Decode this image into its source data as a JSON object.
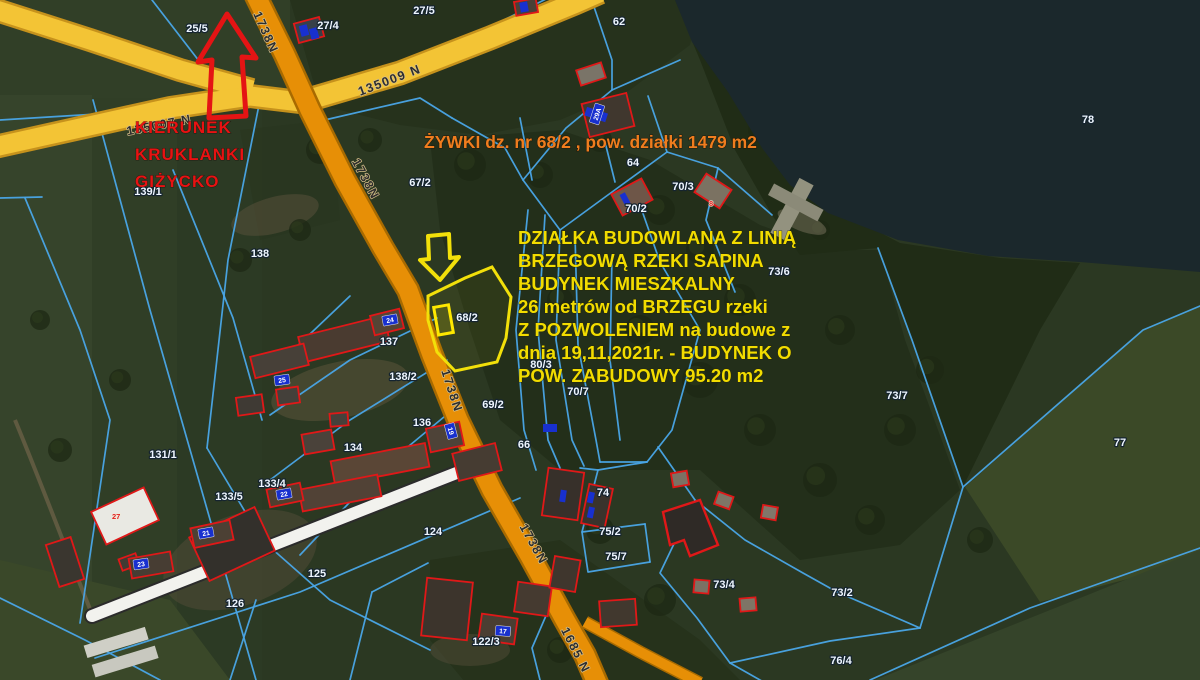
{
  "map": {
    "colors": {
      "parcel_line": "#4aa7e8",
      "road_orange": "#e78f06",
      "road_orange_casing": "#a86a00",
      "road_yellow": "#f3c435",
      "road_yellow_casing": "#c6921c",
      "road_white": "#f2f2ee",
      "highlight_yellow": "#f2e00a",
      "building_outline": "#e01818",
      "address_plate_blue": "#1830cf",
      "lake": "#1b282c",
      "red_note": "#e81212",
      "orange_note": "#ef7d1e",
      "yellow_note": "#f2dc00"
    },
    "highlighted_parcel": {
      "number": "68/2"
    },
    "red_direction_note": {
      "x": 135,
      "y": 133,
      "line_height": 27,
      "lines": [
        "KIERUNEK",
        "KRUKLANKI",
        "GIŻYCKO"
      ]
    },
    "orange_note": {
      "x": 424,
      "y": 148,
      "text": "ŻYWKI dz. nr  68/2  , pow. działki 1479 m2"
    },
    "yellow_note": {
      "x": 518,
      "y": 244,
      "line_height": 23,
      "lines": [
        "DZIAŁKA   BUDOWLANA  Z LINIĄ",
        "BRZEGOWĄ RZEKI SAPINA",
        "BUDYNEK  MIESZKALNY",
        "  26 metrów od  BRZEGU   rzeki",
        "Z  POZWOLENIEM  na  budowe  z",
        "dnia  19,11,2021r.  - BUDYNEK  O",
        "POW.  ZABUDOWY  95.20 m2"
      ]
    },
    "road_labels": [
      {
        "text": "135007 N",
        "x": 160,
        "y": 129,
        "rot": -11
      },
      {
        "text": "135009 N",
        "x": 391,
        "y": 84,
        "rot": -21
      },
      {
        "text": "1738N",
        "x": 262,
        "y": 34,
        "rot": 66
      },
      {
        "text": "1738N",
        "x": 362,
        "y": 181,
        "rot": 62
      },
      {
        "text": "1738N",
        "x": 448,
        "y": 392,
        "rot": 72
      },
      {
        "text": "1738N",
        "x": 530,
        "y": 546,
        "rot": 61
      },
      {
        "text": "1685 N",
        "x": 572,
        "y": 652,
        "rot": 63
      }
    ],
    "parcel_labels": [
      {
        "text": "25/5",
        "x": 197,
        "y": 32
      },
      {
        "text": "27/4",
        "x": 328,
        "y": 29
      },
      {
        "text": "27/5",
        "x": 424,
        "y": 14
      },
      {
        "text": "62",
        "x": 619,
        "y": 25
      },
      {
        "text": "78",
        "x": 1088,
        "y": 123
      },
      {
        "text": "139/1",
        "x": 148,
        "y": 195
      },
      {
        "text": "138",
        "x": 260,
        "y": 257
      },
      {
        "text": "67/2",
        "x": 420,
        "y": 186
      },
      {
        "text": "64",
        "x": 633,
        "y": 166
      },
      {
        "text": "70/3",
        "x": 683,
        "y": 190
      },
      {
        "text": "70/2",
        "x": 636,
        "y": 212
      },
      {
        "text": "73/6",
        "x": 779,
        "y": 275
      },
      {
        "text": "68/2",
        "x": 467,
        "y": 321
      },
      {
        "text": "80/3",
        "x": 541,
        "y": 368
      },
      {
        "text": "70/7",
        "x": 578,
        "y": 395
      },
      {
        "text": "69/2",
        "x": 493,
        "y": 408
      },
      {
        "text": "66",
        "x": 524,
        "y": 448
      },
      {
        "text": "73/7",
        "x": 897,
        "y": 399
      },
      {
        "text": "77",
        "x": 1120,
        "y": 446
      },
      {
        "text": "131/1",
        "x": 163,
        "y": 458
      },
      {
        "text": "133/4",
        "x": 272,
        "y": 487
      },
      {
        "text": "133/5",
        "x": 229,
        "y": 500
      },
      {
        "text": "137",
        "x": 389,
        "y": 345
      },
      {
        "text": "138/2",
        "x": 403,
        "y": 380
      },
      {
        "text": "136",
        "x": 422,
        "y": 426
      },
      {
        "text": "134",
        "x": 353,
        "y": 451
      },
      {
        "text": "125",
        "x": 317,
        "y": 577
      },
      {
        "text": "126",
        "x": 235,
        "y": 607
      },
      {
        "text": "124",
        "x": 433,
        "y": 535
      },
      {
        "text": "122/3",
        "x": 486,
        "y": 645
      },
      {
        "text": "74",
        "x": 603,
        "y": 496
      },
      {
        "text": "75/2",
        "x": 610,
        "y": 535
      },
      {
        "text": "75/7",
        "x": 616,
        "y": 560
      },
      {
        "text": "73/4",
        "x": 724,
        "y": 588
      },
      {
        "text": "73/2",
        "x": 842,
        "y": 596
      },
      {
        "text": "76/4",
        "x": 841,
        "y": 664
      }
    ],
    "address_plates": [
      {
        "text": "24",
        "x": 390,
        "y": 320,
        "rot": -10
      },
      {
        "text": "25",
        "x": 282,
        "y": 380,
        "rot": -8
      },
      {
        "text": "22",
        "x": 284,
        "y": 494,
        "rot": -10
      },
      {
        "text": "21",
        "x": 206,
        "y": 533,
        "rot": -10
      },
      {
        "text": "23",
        "x": 141,
        "y": 564,
        "rot": -8
      },
      {
        "text": "17",
        "x": 503,
        "y": 631,
        "rot": 5
      },
      {
        "text": "19",
        "x": 451,
        "y": 431,
        "rot": 75
      },
      {
        "text": "29A",
        "x": 597,
        "y": 114,
        "rot": -72
      }
    ],
    "building_tags": [
      {
        "text": "27",
        "x": 112,
        "y": 519
      },
      {
        "text": "8",
        "x": 709,
        "y": 206
      }
    ]
  }
}
